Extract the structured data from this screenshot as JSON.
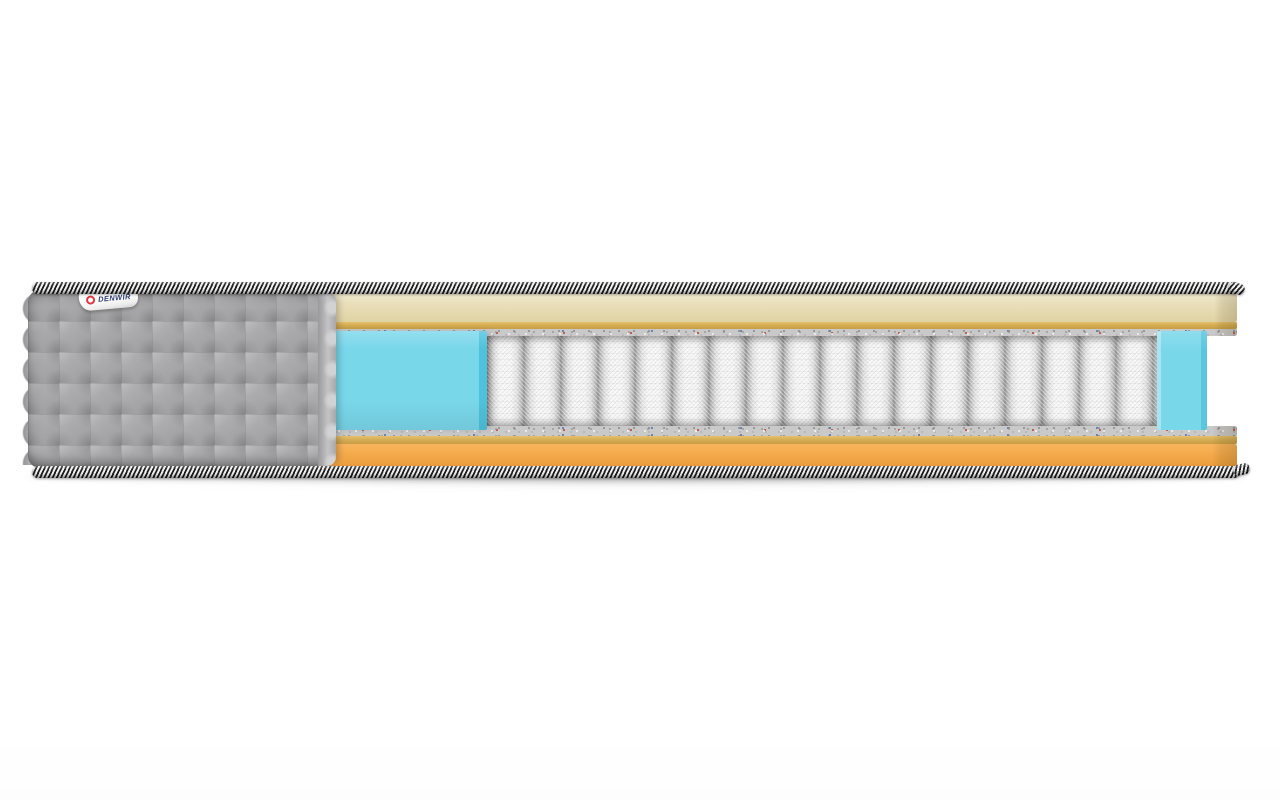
{
  "scene": {
    "alt": "Cross-section cutaway render of a mattress showing a gray quilted cover with brand tag, cream quilted top panel, gold border tape, gray felt pads, cyan foam layer, white pocket springs and an orange base foam layer, edged with black-and-white striped piping cords",
    "background": "#ffffff"
  },
  "brand_label": {
    "text": "DENWIR",
    "logo_icon": "red-ring"
  },
  "colors": {
    "cover-gray": "#a9a9ab",
    "top-fabric-cream": "#e9dfba",
    "tape-gold": "#d6ad55",
    "felt-gray": "#c9c9ca",
    "foam-cyan": "#79d7ea",
    "foam-cyan-dark": "#4ec2dc",
    "spring-white": "#f6f6f6",
    "spring-gap": "#8f8f8f",
    "base-orange": "#f5ab4d",
    "piping-black": "#1e1e1e",
    "piping-white": "#efefef",
    "label-navy": "#2c3d74",
    "label-red": "#e23744"
  }
}
